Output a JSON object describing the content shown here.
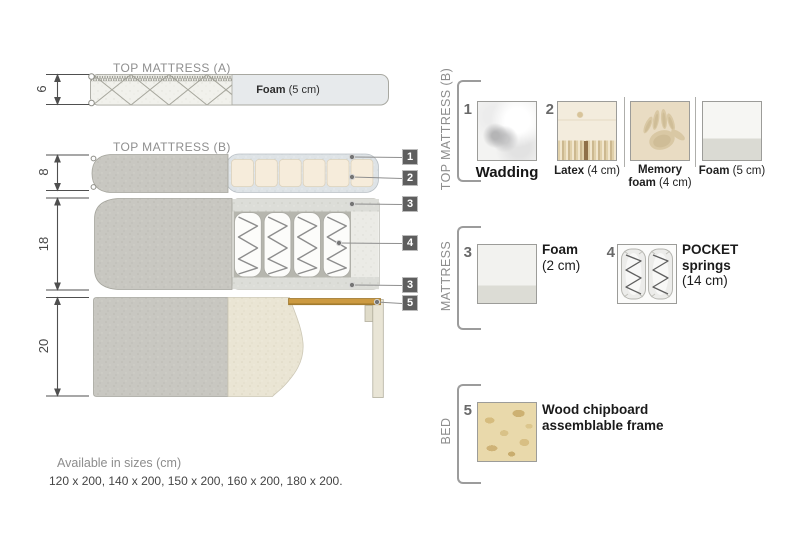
{
  "diagram": {
    "topA": {
      "title": "TOP MATTRESS (A)",
      "foam_bold": "Foam",
      "foam_rest": " (5 cm)",
      "dim": "6"
    },
    "topB": {
      "title": "TOP MATTRESS (B)",
      "dim": "8"
    },
    "mattress": {
      "dim": "18"
    },
    "bed": {
      "dim": "20"
    },
    "callouts": {
      "c1": "1",
      "c2": "2",
      "c3": "3",
      "c4": "4",
      "c3b": "3",
      "c5": "5"
    }
  },
  "panel": {
    "topb": {
      "title": "TOP MATTRESS (B)",
      "n1": "1",
      "wadding_caption": "Wadding",
      "n2": "2",
      "latex_name": "Latex",
      "latex_size": " (4 cm)",
      "memory_line1": "Memory",
      "memory_bold": "foam",
      "memory_size": " (4 cm)",
      "foam_name": "Foam",
      "foam_size": " (5 cm)"
    },
    "mattress": {
      "title": "MATTRESS",
      "n3": "3",
      "foam_name": "Foam",
      "foam_size": "(2 cm)",
      "n4": "4",
      "pocket_line1": "POCKET",
      "pocket_line2": "springs",
      "pocket_size": "(14 cm)"
    },
    "bed": {
      "title": "BED",
      "n5": "5",
      "line1": "Wood chipboard",
      "line2": "assemblable frame"
    }
  },
  "footer": {
    "line1": "Available in sizes (cm)",
    "line2": "120 x 200, 140 x 200, 150 x 200, 160 x 200, 180 x 200."
  }
}
